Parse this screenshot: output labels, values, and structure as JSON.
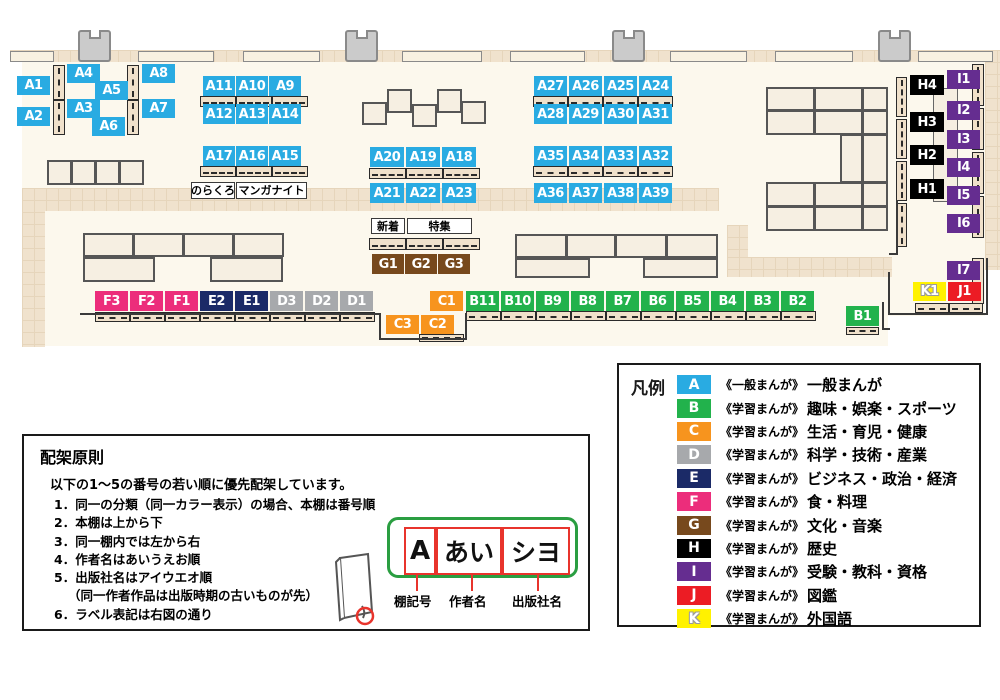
{
  "map": {
    "shelf_labels": [
      "A1",
      "A2",
      "A4",
      "A5",
      "A3",
      "A6",
      "A8",
      "A7",
      "A11",
      "A10",
      "A9",
      "A12",
      "A13",
      "A14",
      "A17",
      "A16",
      "A15",
      "A20",
      "A19",
      "A18",
      "A21",
      "A22",
      "A23",
      "A27",
      "A26",
      "A25",
      "A24",
      "A28",
      "A29",
      "A30",
      "A31",
      "A35",
      "A34",
      "A33",
      "A32",
      "A36",
      "A37",
      "A38",
      "A39",
      "G1",
      "G2",
      "G3",
      "F3",
      "F2",
      "F1",
      "E2",
      "E1",
      "D3",
      "D2",
      "D1",
      "C1",
      "C3",
      "C2",
      "B11",
      "B10",
      "B9",
      "B8",
      "B7",
      "B6",
      "B5",
      "B4",
      "B3",
      "B2",
      "B1",
      "H4",
      "H3",
      "H2",
      "H1",
      "I1",
      "I2",
      "I3",
      "I4",
      "I5",
      "I6",
      "I7",
      "K1",
      "J1"
    ],
    "area_labels": [
      {
        "id": "norakuro",
        "text": "のらくろ"
      },
      {
        "id": "manga_night",
        "text": "マンガナイト"
      },
      {
        "id": "shinchaku",
        "text": "新着"
      },
      {
        "id": "tokushu",
        "text": "特集"
      }
    ]
  },
  "legend": {
    "title": "凡例",
    "items": [
      {
        "code": "A",
        "color": "#29abe2",
        "series": "《一般まんが》",
        "label": "一般まんが"
      },
      {
        "code": "B",
        "color": "#22b24c",
        "series": "《学習まんが》",
        "label": "趣味・娯楽・スポーツ"
      },
      {
        "code": "C",
        "color": "#f7941e",
        "series": "《学習まんが》",
        "label": "生活・育児・健康"
      },
      {
        "code": "D",
        "color": "#a7a9ac",
        "series": "《学習まんが》",
        "label": "科学・技術・産業"
      },
      {
        "code": "E",
        "color": "#1b2a67",
        "series": "《学習まんが》",
        "label": "ビジネス・政治・経済"
      },
      {
        "code": "F",
        "color": "#ec2d7b",
        "series": "《学習まんが》",
        "label": "食・料理"
      },
      {
        "code": "G",
        "color": "#77491d",
        "series": "《学習まんが》",
        "label": "文化・音楽"
      },
      {
        "code": "H",
        "color": "#000000",
        "series": "《学習まんが》",
        "label": "歴史"
      },
      {
        "code": "I",
        "color": "#652d90",
        "series": "《学習まんが》",
        "label": "受験・教科・資格"
      },
      {
        "code": "J",
        "color": "#ec1c24",
        "series": "《学習まんが》",
        "label": "図鑑"
      },
      {
        "code": "K",
        "color": "#fff200",
        "series": "《学習まんが》",
        "label": "外国語"
      }
    ]
  },
  "principles": {
    "title": "配架原則",
    "intro": "以下の1～5の番号の若い順に優先配架しています。",
    "items": [
      {
        "text": "1．同一の分類（同一カラー表示）の場合、本棚は番号順",
        "indent": false
      },
      {
        "text": "2．本棚は上から下",
        "indent": false
      },
      {
        "text": "3．同一棚内では左から右",
        "indent": false
      },
      {
        "text": "4．作者名はあいうえお順",
        "indent": false
      },
      {
        "text": "5．出版社名はアイウエオ順",
        "indent": false
      },
      {
        "text": "（同一作者作品は出版時期の古いものが先）",
        "indent": true
      },
      {
        "text": "6．ラベル表記は右図の通り",
        "indent": false
      }
    ],
    "label_example": {
      "shelf": "A",
      "author": "あい",
      "publisher": "シヨ"
    },
    "annotations": [
      "棚記号",
      "作者名",
      "出版社名"
    ]
  }
}
